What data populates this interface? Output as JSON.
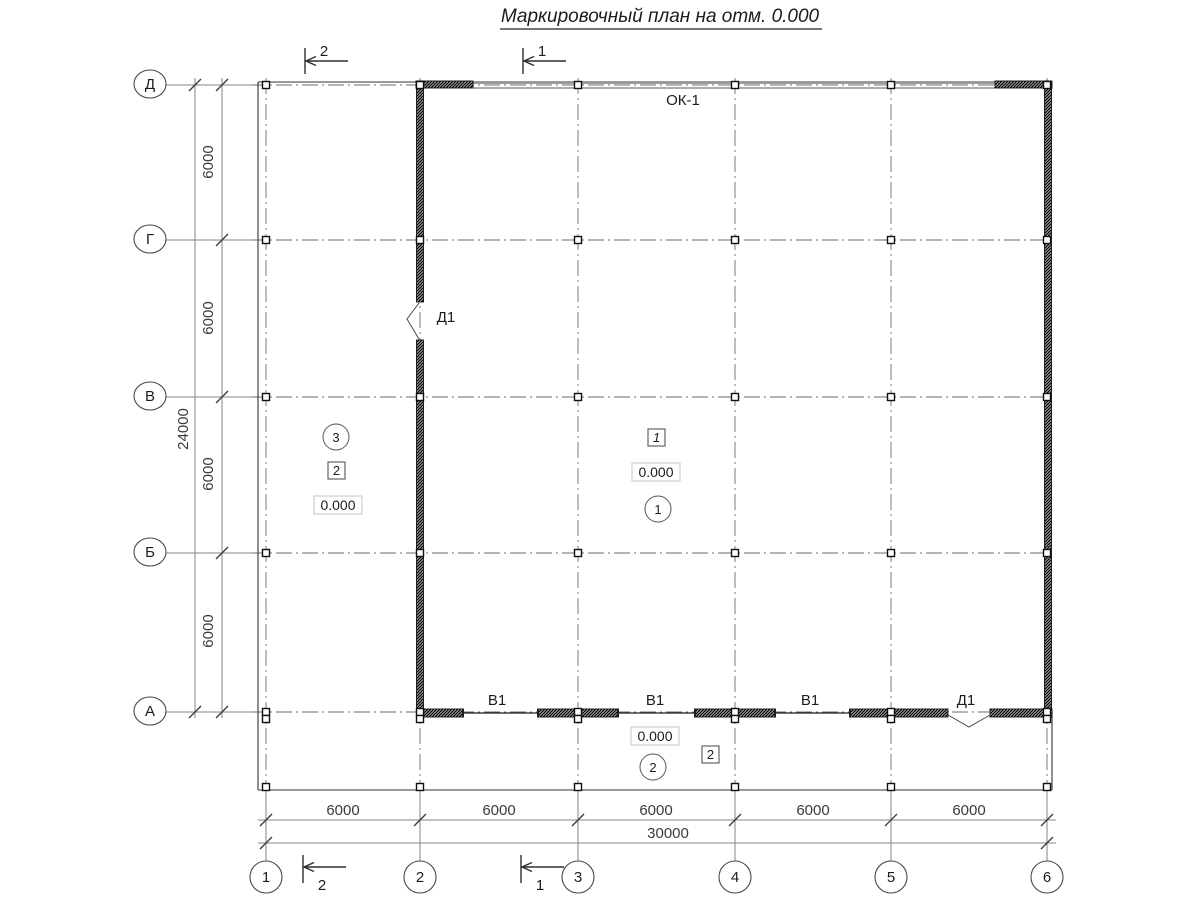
{
  "title": "Маркировочный план на отм. 0.000",
  "axes": {
    "rows": [
      "Д",
      "Г",
      "В",
      "Б",
      "А"
    ],
    "cols": [
      "1",
      "2",
      "3",
      "4",
      "5",
      "6"
    ]
  },
  "dims": {
    "left_total": "24000",
    "left_segments": [
      "6000",
      "6000",
      "6000",
      "6000"
    ],
    "bottom_segments": [
      "6000",
      "6000",
      "6000",
      "6000",
      "6000"
    ],
    "bottom_total": "30000"
  },
  "sections": {
    "cut_1": "1",
    "cut_2": "2"
  },
  "marks": {
    "window": "ОК-1",
    "door": "Д1",
    "gate": "В1",
    "elevation": "0.000",
    "room_left": "3",
    "room_hall": "1",
    "room_strip": "2",
    "box_left": "2",
    "box_hall": "1",
    "box_strip": "2"
  },
  "colors": {
    "wall": "#101010",
    "window_band": "#9a9a9a",
    "dimension": "#3a3a3a"
  }
}
